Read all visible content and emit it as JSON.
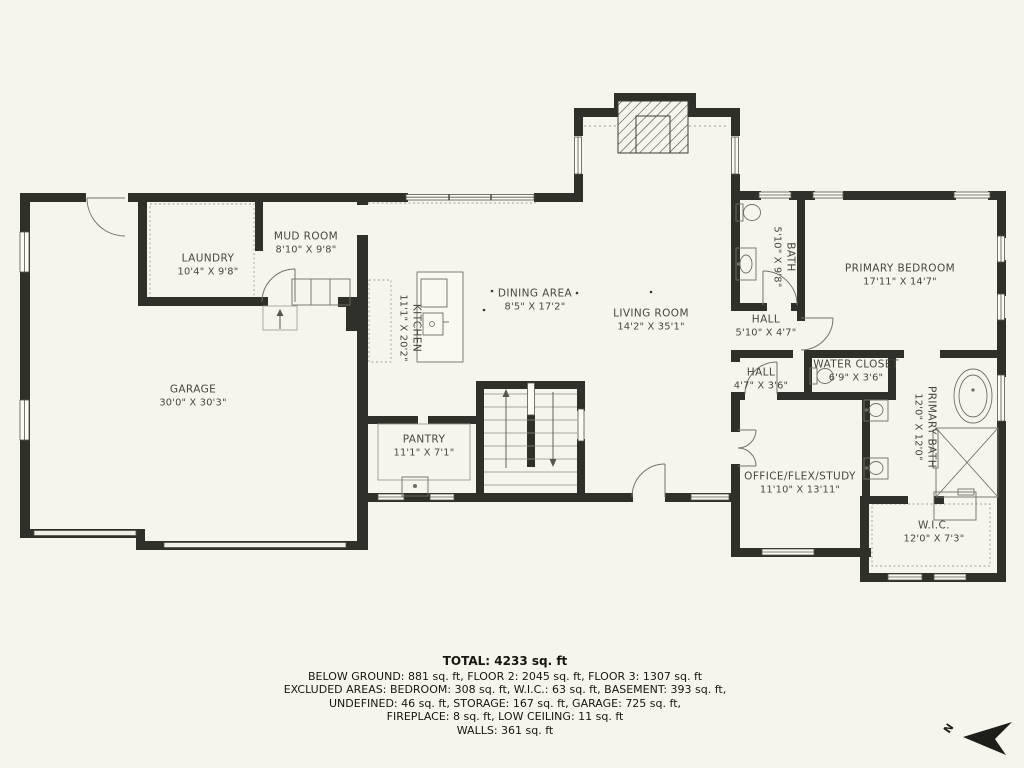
{
  "plan": {
    "rooms": [
      {
        "id": "garage",
        "name": "GARAGE",
        "dims": "30'0\" X 30'3\""
      },
      {
        "id": "laundry",
        "name": "LAUNDRY",
        "dims": "10'4\" X 9'8\""
      },
      {
        "id": "mud-room",
        "name": "MUD ROOM",
        "dims": "8'10\" X 9'8\""
      },
      {
        "id": "kitchen",
        "name": "KITCHEN",
        "dims": "11'1\" X 20'2\""
      },
      {
        "id": "dining-area",
        "name": "DINING AREA",
        "dims": "8'5\" X 17'2\""
      },
      {
        "id": "living-room",
        "name": "LIVING ROOM",
        "dims": "14'2\" X 35'1\""
      },
      {
        "id": "bath",
        "name": "BATH",
        "dims": "5'10\" X 9'8\""
      },
      {
        "id": "hall-upper",
        "name": "HALL",
        "dims": "5'10\" X 4'7\""
      },
      {
        "id": "hall-lower",
        "name": "HALL",
        "dims": "4'7\" X 3'6\""
      },
      {
        "id": "water-closet",
        "name": "WATER CLOSET",
        "dims": "6'9\" X 3'6\""
      },
      {
        "id": "primary-bedroom",
        "name": "PRIMARY BEDROOM",
        "dims": "17'11\" X 14'7\""
      },
      {
        "id": "primary-bath",
        "name": "PRIMARY BATH",
        "dims": "12'0\" X 12'0\""
      },
      {
        "id": "office-flex-study",
        "name": "OFFICE/FLEX/STUDY",
        "dims": "11'10\" X 13'11\""
      },
      {
        "id": "wic",
        "name": "W.I.C.",
        "dims": "12'0\" X 7'3\""
      },
      {
        "id": "pantry",
        "name": "PANTRY",
        "dims": "11'1\" X 7'1\""
      }
    ],
    "summary": {
      "total": "TOTAL: 4233 sq. ft",
      "lines": [
        "BELOW GROUND: 881 sq. ft, FLOOR 2: 2045 sq. ft, FLOOR 3: 1307 sq. ft",
        "EXCLUDED AREAS: BEDROOM: 308 sq. ft, W.I.C.: 63 sq. ft, BASEMENT: 393 sq. ft,",
        "UNDEFINED: 46 sq. ft, STORAGE: 167 sq. ft, GARAGE: 725 sq. ft,",
        "FIREPLACE: 8 sq. ft, LOW CEILING: 11 sq. ft",
        "WALLS: 361 sq. ft"
      ]
    },
    "compass": {
      "label": "N"
    },
    "colors": {
      "background": "#f6f5ed",
      "wall": "#30302b",
      "thin_line": "#6f6f66",
      "text": "#47473f"
    }
  }
}
